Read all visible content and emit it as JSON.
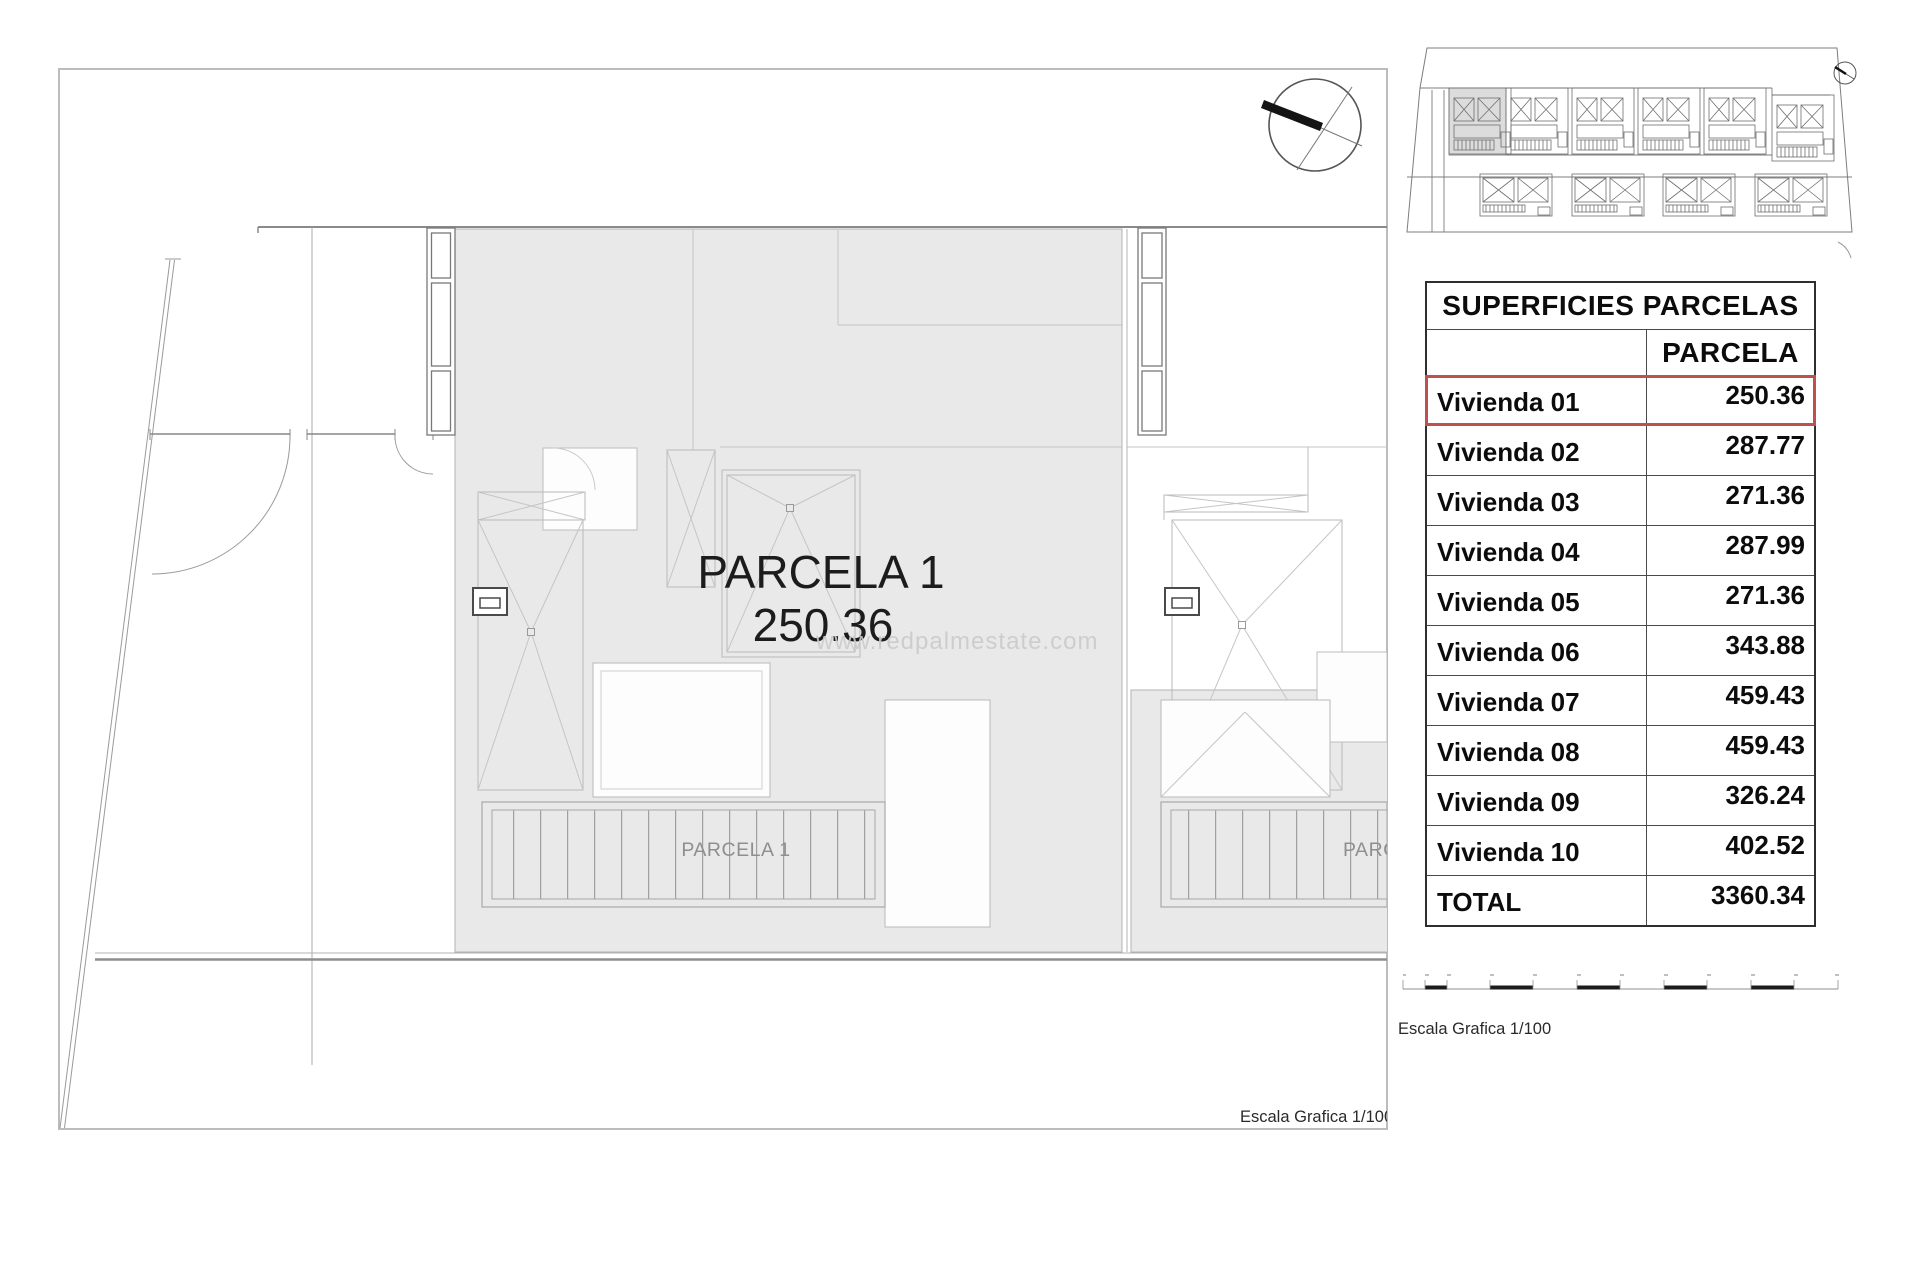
{
  "drawing": {
    "parcel_title": "PARCELA 1",
    "parcel_area": "250.36",
    "strip_label": "PARCELA 1",
    "strip_label_clipped": "PARC",
    "scale_caption": "Escala Grafica 1/100"
  },
  "watermark": {
    "text": "www.redpalmestate.com",
    "color": "#cbcbcb"
  },
  "overview": {
    "highlight_color": "#dcdcdc"
  },
  "scalebar": {
    "caption": "Escala Grafica 1/100"
  },
  "table": {
    "title": "SUPERFICIES PARCELAS",
    "column_header": "PARCELA",
    "highlight_color": "#c0504d",
    "rows": [
      {
        "label": "Vivienda 01",
        "value": "250.36"
      },
      {
        "label": "Vivienda 02",
        "value": "287.77"
      },
      {
        "label": "Vivienda 03",
        "value": "271.36"
      },
      {
        "label": "Vivienda 04",
        "value": "287.99"
      },
      {
        "label": "Vivienda 05",
        "value": "271.36"
      },
      {
        "label": "Vivienda 06",
        "value": "343.88"
      },
      {
        "label": "Vivienda 07",
        "value": "459.43"
      },
      {
        "label": "Vivienda 08",
        "value": "459.43"
      },
      {
        "label": "Vivienda 09",
        "value": "326.24"
      },
      {
        "label": "Vivienda 10",
        "value": "402.52"
      }
    ],
    "total": {
      "label": "TOTAL",
      "value": "3360.34"
    }
  }
}
